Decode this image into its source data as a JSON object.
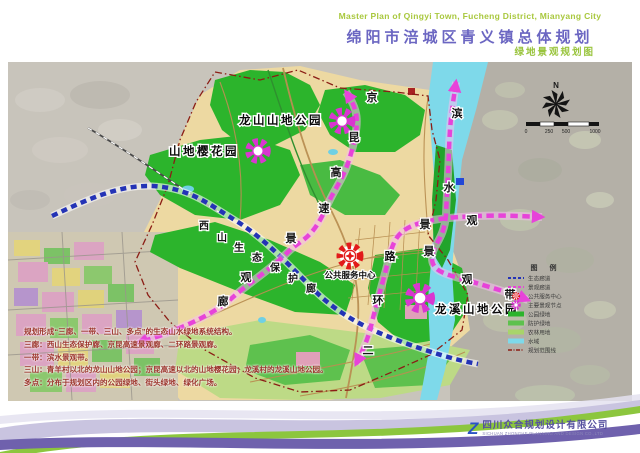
{
  "header": {
    "title_en": "Master Plan of Qingyi Town, Fucheng District, Mianyang City",
    "title_zh": "绵阳市涪城区青义镇总体规划",
    "subtitle": "绿地景观规划图"
  },
  "map": {
    "labels": {
      "longshan": "龙山山地公园",
      "cherry": "山地樱花园",
      "longxi": "龙溪山地公园",
      "service_center": "公共服务中心"
    },
    "corridors": {
      "jingkun": [
        "京",
        "昆",
        "高",
        "速",
        "景",
        "观",
        "廊"
      ],
      "xishan": [
        "西",
        "山",
        "生",
        "态",
        "保",
        "护",
        "廊"
      ],
      "erhuan": [
        "二",
        "环",
        "路"
      ],
      "erhuan_wing": [
        "景",
        "观"
      ],
      "binshui": [
        "滨",
        "水",
        "景",
        "观",
        "带"
      ]
    },
    "compass": "N",
    "scale_labels": [
      "0",
      "250",
      "500",
      "1000"
    ]
  },
  "legend": {
    "title": "图 例",
    "items": [
      {
        "label": "生态廊道",
        "color": "#2433b6"
      },
      {
        "label": "景观廊道",
        "color": "#e743d9"
      },
      {
        "label": "公共服务中心",
        "color": "#e21a1a"
      },
      {
        "label": "主要景观节点",
        "color": "#d936d0"
      },
      {
        "label": "公园绿地",
        "color": "#2cb42c"
      },
      {
        "label": "防护绿地",
        "color": "#5ec14e"
      },
      {
        "label": "农林用地",
        "color": "#a8d46a"
      },
      {
        "label": "水域",
        "color": "#7ed9ea"
      },
      {
        "label": "规划范围线",
        "color": "#8b1d15"
      }
    ]
  },
  "notes": {
    "line1": "规划形成“三廊、一带、三山、多点”的生态山水绿地系统结构。",
    "line2": "三廊：西山生态保护廊、京昆高速景观廊、二环路景观廊。",
    "line3": "一带：滨水景观带。",
    "line4": "三山：青羊村以北的龙山山地公园；京昆高速以北的山地樱花园；龙溪村的龙溪山地公园。",
    "line5": "多点：分布于规划区内的公园绿地、街头绿地、绿化广场。"
  },
  "footer": {
    "logo_letter": "Z",
    "company_zh": "四川众合规划设计有限公司",
    "company_en": "SICHUAN ZHONGHE PLANNING AND DESIGN CO.,LTD"
  }
}
